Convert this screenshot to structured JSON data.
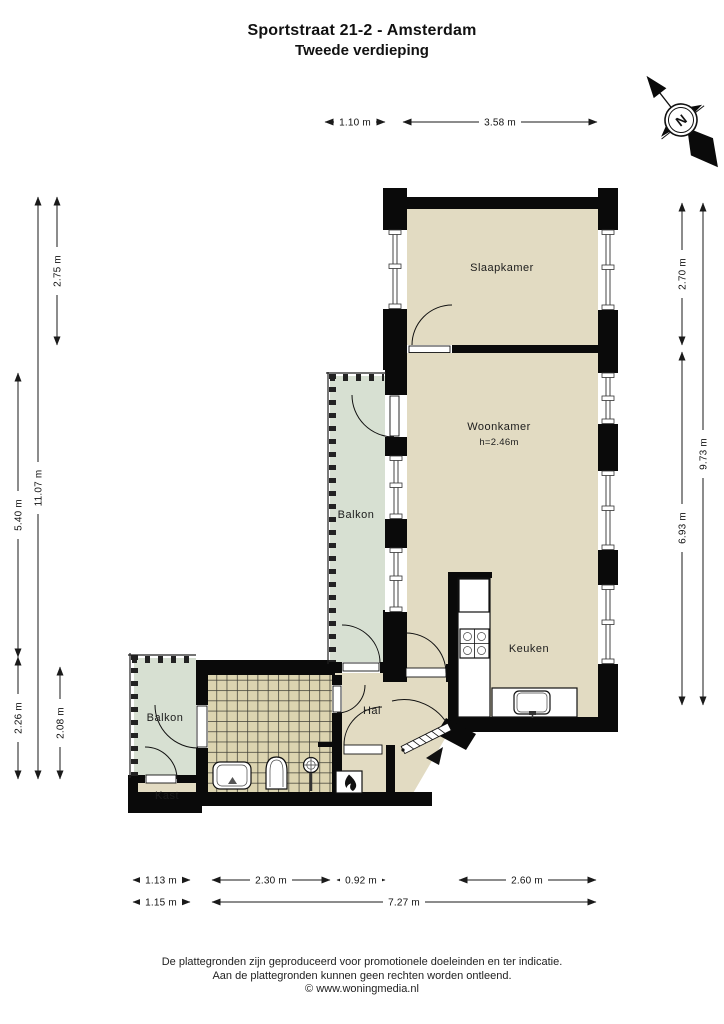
{
  "title": {
    "line1": "Sportstraat 21-2 - Amsterdam",
    "line2": "Tweede verdieping"
  },
  "compass": {
    "north": "N"
  },
  "rooms": {
    "slaapkamer": "Slaapkamer",
    "woonkamer": "Woonkamer",
    "woonkamer_ceiling": "h=2.46m",
    "balkon_mid": "Balkon",
    "balkon_low": "Balkon",
    "keuken": "Keuken",
    "hal": "Hal",
    "kast": "Kast"
  },
  "dims": {
    "top_1": "1.10 m",
    "top_2": "3.58 m",
    "left_1": "2.75 m",
    "left_2": "11.07 m",
    "left_3": "5.40 m",
    "left_4": "2.26 m",
    "left_5": "2.08 m",
    "right_1": "2.70 m",
    "right_2": "9.73 m",
    "right_3": "6.93 m",
    "bottom_1": "1.13 m",
    "bottom_2": "2.30 m",
    "bottom_3": "0.92 m",
    "bottom_4": "2.60 m",
    "bottom_5": "1.15 m",
    "bottom_6": "7.27 m"
  },
  "footer": {
    "line1": "De plattegronden zijn geproduceerd voor promotionele doeleinden en ter indicatie.",
    "line2": "Aan de plattegronden kunnen geen rechten worden ontleend.",
    "line3": "© www.woningmedia.nl"
  },
  "colors": {
    "room": "#e2dbc2",
    "balcony": "#d7e0d2",
    "tile": "#dcd4b0",
    "wall": "#0a0a0a"
  }
}
